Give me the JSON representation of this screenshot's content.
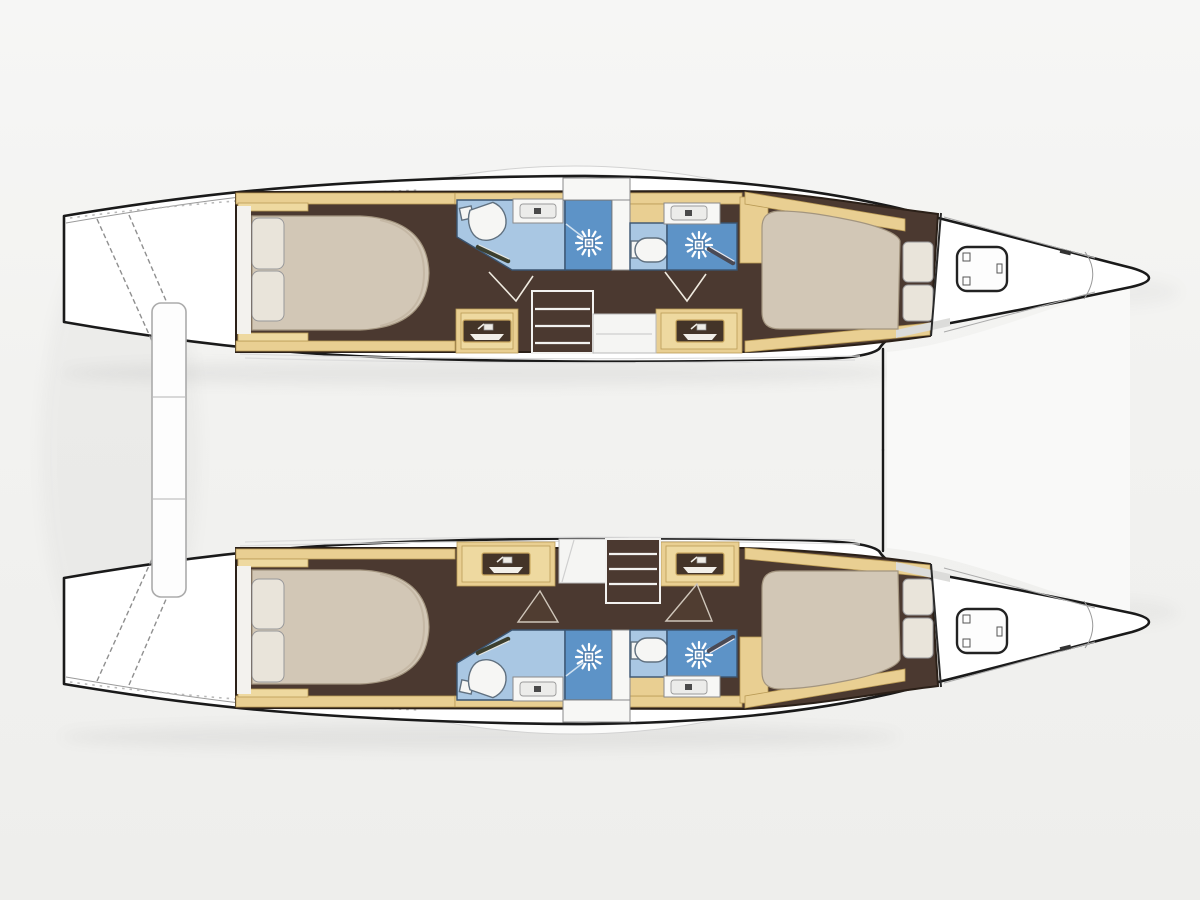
{
  "document": {
    "kind": "catamaran-interior-floor-plan",
    "view": "overhead-deck-plan",
    "orientation": "bows-pointing-right",
    "visible_text": ""
  },
  "colors": {
    "background": "#f2f2f0",
    "hull-white": "#ffffff",
    "outline": "#1a1a1a",
    "wood": "#e9cf92",
    "wood-inner": "#eed9a0",
    "wood-edge": "#b99a55",
    "floor-brown": "#4b3930",
    "wall-dark": "#2b2018",
    "bath-floor": "#a9c7e3",
    "shower-floor": "#5d93c7",
    "wet-outline": "#3a5470",
    "mattress": "#d2c7b6",
    "mattress-edge": "#a3957f",
    "pillow": "#e9e4da",
    "fixture-white": "#f6f6f4",
    "fixture-edge": "#60707f",
    "deck-line": "#dcdcdc",
    "beam-edge": "#ababab",
    "door-line": "#efeadf"
  },
  "vessel": {
    "type": "sailing-catamaran",
    "hull_count": 2,
    "crossbeam": {
      "name": "aft-crossbeam",
      "segments": 3
    },
    "hulls": [
      {
        "id": "port-hull",
        "position": "top",
        "rooms": [
          {
            "name": "transom-steps"
          },
          {
            "name": "aft-cabin",
            "furniture": [
              "double-berth",
              "pillows",
              "side-shelves"
            ]
          },
          {
            "name": "aft-head",
            "fixtures": [
              "toilet",
              "washbasin",
              "shower"
            ]
          },
          {
            "name": "companionway",
            "fixtures": [
              "steps",
              "landing",
              "storage-cabinet",
              "storage-cabinet"
            ]
          },
          {
            "name": "forward-head",
            "fixtures": [
              "toilet",
              "washbasin",
              "shower"
            ]
          },
          {
            "name": "forward-cabin",
            "furniture": [
              "double-berth",
              "pillows",
              "wardrobe"
            ]
          },
          {
            "name": "forepeak",
            "fixtures": [
              "deck-hatch"
            ]
          }
        ]
      },
      {
        "id": "starboard-hull",
        "position": "bottom",
        "rooms": [
          {
            "name": "transom-steps"
          },
          {
            "name": "aft-cabin",
            "furniture": [
              "double-berth",
              "pillows",
              "side-shelves"
            ]
          },
          {
            "name": "aft-head",
            "fixtures": [
              "toilet",
              "washbasin",
              "shower"
            ]
          },
          {
            "name": "companionway",
            "fixtures": [
              "landing",
              "steps",
              "storage-cabinet",
              "storage-cabinet"
            ]
          },
          {
            "name": "forward-head",
            "fixtures": [
              "toilet",
              "washbasin",
              "shower"
            ]
          },
          {
            "name": "forward-cabin",
            "furniture": [
              "double-berth",
              "pillows",
              "wardrobe"
            ]
          },
          {
            "name": "forepeak",
            "fixtures": [
              "deck-hatch"
            ]
          }
        ]
      }
    ]
  }
}
